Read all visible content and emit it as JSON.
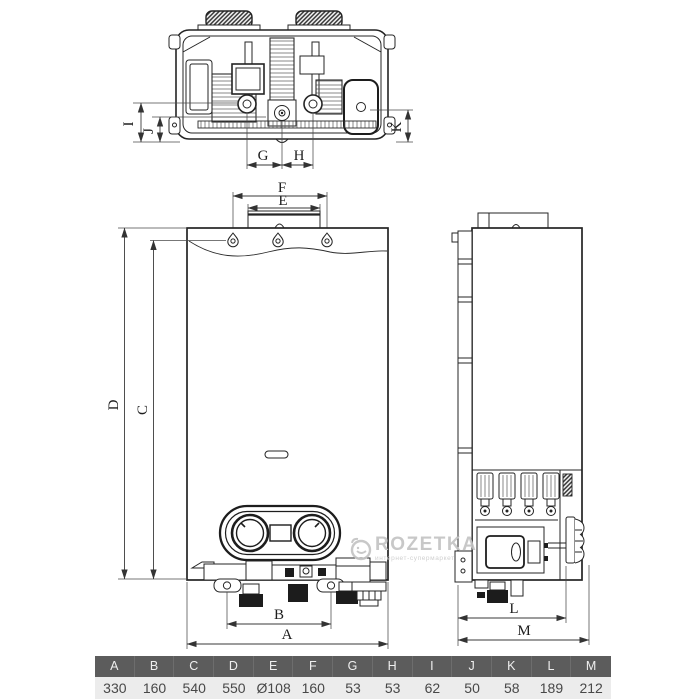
{
  "title": "Gas water heater dimensional drawing",
  "dims": {
    "A": "A",
    "B": "B",
    "C": "C",
    "D": "D",
    "E": "E",
    "F": "F",
    "G": "G",
    "H": "H",
    "I": "I",
    "J": "J",
    "K": "K",
    "L": "L",
    "M": "M"
  },
  "watermark": {
    "brand": "ROZETKA",
    "tagline": "интернет-супермаркет"
  },
  "icons": {
    "rozetka_logo": "smiley-face-outline"
  },
  "spec_table": {
    "headers": [
      "A",
      "B",
      "C",
      "D",
      "E",
      "F",
      "G",
      "H",
      "I",
      "J",
      "K",
      "L",
      "M"
    ],
    "values": [
      "330",
      "160",
      "540",
      "550",
      "Ø108",
      "160",
      "53",
      "53",
      "62",
      "50",
      "58",
      "189",
      "212"
    ]
  },
  "colors": {
    "drawing_line": "#242424",
    "table_header_bg": "#5c5c5c",
    "table_header_text": "#efefef",
    "table_row_bg": "#ececec",
    "table_row_text": "#484848",
    "watermark": "#c4c4c4"
  }
}
